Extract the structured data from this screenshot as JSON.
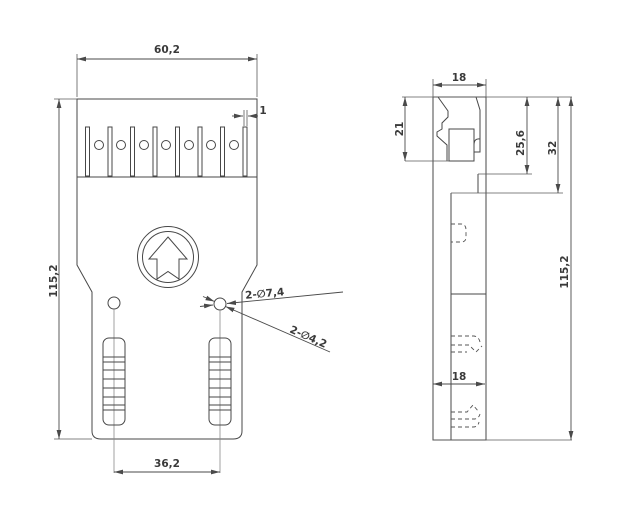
{
  "front_view": {
    "dim_width": "60,2",
    "dim_slot_width": "1",
    "dim_height": "115,2",
    "dim_hole_spacing": "36,2",
    "callout_holes_large": "2-∅7,4",
    "callout_holes_small": "2-∅4,2"
  },
  "side_view": {
    "dim_depth_top": "18",
    "dim_clip_height": "21",
    "dim_step_1": "25,6",
    "dim_step_2": "32",
    "dim_height": "115,2",
    "dim_depth_body": "18"
  },
  "colors": {
    "line": "#474747",
    "centerline": "#8a8a8a",
    "background": "#ffffff"
  }
}
